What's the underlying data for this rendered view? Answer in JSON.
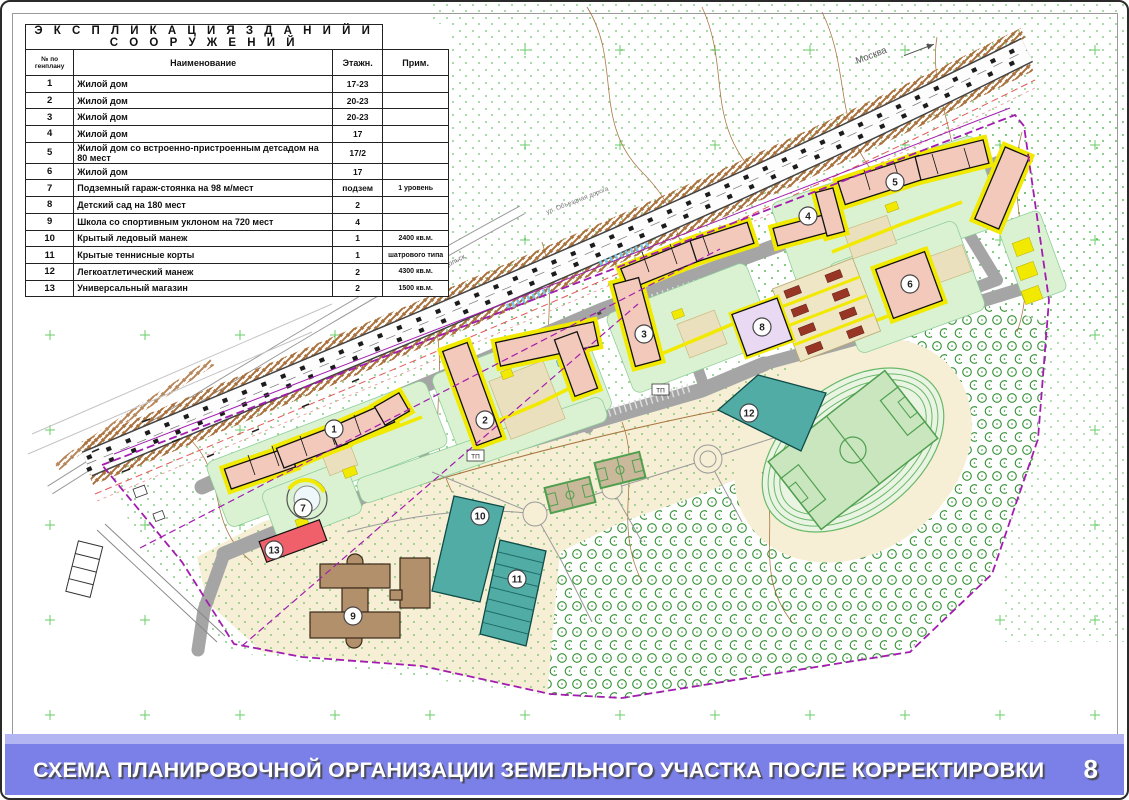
{
  "table": {
    "title": "Э К С П Л И К А Ц И Я   З Д А Н И Й   И   С О О Р У Ж Е Н И Й",
    "columns": [
      "№ по генплану",
      "Наименование",
      "Этажн.",
      "Прим."
    ],
    "rows": [
      {
        "num": "1",
        "name": "Жилой дом",
        "floors": "17-23",
        "note": ""
      },
      {
        "num": "2",
        "name": "Жилой дом",
        "floors": "20-23",
        "note": ""
      },
      {
        "num": "3",
        "name": "Жилой дом",
        "floors": "20-23",
        "note": ""
      },
      {
        "num": "4",
        "name": "Жилой дом",
        "floors": "17",
        "note": ""
      },
      {
        "num": "5",
        "name": "Жилой дом со встроенно-пристроенным детсадом на 80 мест",
        "floors": "17/2",
        "note": ""
      },
      {
        "num": "6",
        "name": "Жилой дом",
        "floors": "17",
        "note": ""
      },
      {
        "num": "7",
        "name": "Подземный гараж-стоянка на 98 м/мест",
        "floors": "подзем",
        "note": "1 уровень"
      },
      {
        "num": "8",
        "name": "Детский сад на 180 мест",
        "floors": "2",
        "note": ""
      },
      {
        "num": "9",
        "name": "Школа со спортивным уклоном на 720 мест",
        "floors": "4",
        "note": ""
      },
      {
        "num": "10",
        "name": "Крытый ледовый манеж",
        "floors": "1",
        "note": "2400 кв.м."
      },
      {
        "num": "11",
        "name": "Крытые теннисные корты",
        "floors": "1",
        "note": "шатрового типа"
      },
      {
        "num": "12",
        "name": "Легкоатлетический манеж",
        "floors": "2",
        "note": "4300 кв.м."
      },
      {
        "num": "13",
        "name": "Универсальный магазин",
        "floors": "2",
        "note": "1500 кв.м."
      }
    ]
  },
  "map": {
    "labels": {
      "moscow": "Москва",
      "ring_road": "ул. Объездная дорога",
      "podolsk": "Подольск",
      "tp": "ТП"
    },
    "markers": [
      {
        "id": "1",
        "x": 332,
        "y": 427
      },
      {
        "id": "2",
        "x": 483,
        "y": 418
      },
      {
        "id": "3",
        "x": 642,
        "y": 332
      },
      {
        "id": "4",
        "x": 806,
        "y": 214
      },
      {
        "id": "5",
        "x": 893,
        "y": 180
      },
      {
        "id": "6",
        "x": 908,
        "y": 282
      },
      {
        "id": "7",
        "x": 301,
        "y": 506
      },
      {
        "id": "8",
        "x": 760,
        "y": 325
      },
      {
        "id": "9",
        "x": 351,
        "y": 614
      },
      {
        "id": "10",
        "x": 478,
        "y": 514
      },
      {
        "id": "11",
        "x": 515,
        "y": 577
      },
      {
        "id": "12",
        "x": 747,
        "y": 411
      },
      {
        "id": "13",
        "x": 272,
        "y": 548
      }
    ]
  },
  "footer": {
    "title": "СХЕМА ПЛАНИРОВОЧНОЙ ОРГАНИЗАЦИИ ЗЕМЕЛЬНОГО УЧАСТКА ПОСЛЕ КОРРЕКТИРОВКИ",
    "page": "8"
  },
  "colors": {
    "footer_bar": "#7a80e7",
    "footer_strip": "#b2b5f2",
    "residential": "#f3c9bb",
    "sidewalk_yellow": "#f1e900",
    "road_gray": "#a5a5a5",
    "yard_green": "#dbf2d2",
    "park_cream": "#f6efd5",
    "sport_teal": "#52aca6",
    "school_brown": "#b3906c",
    "kindergarten_lavender": "#e9d9f2",
    "store_red": "#ef606a",
    "boundary_magenta": "#a21caf",
    "forest_green": "#2f8f2f",
    "contour_brown": "#a06a32"
  }
}
